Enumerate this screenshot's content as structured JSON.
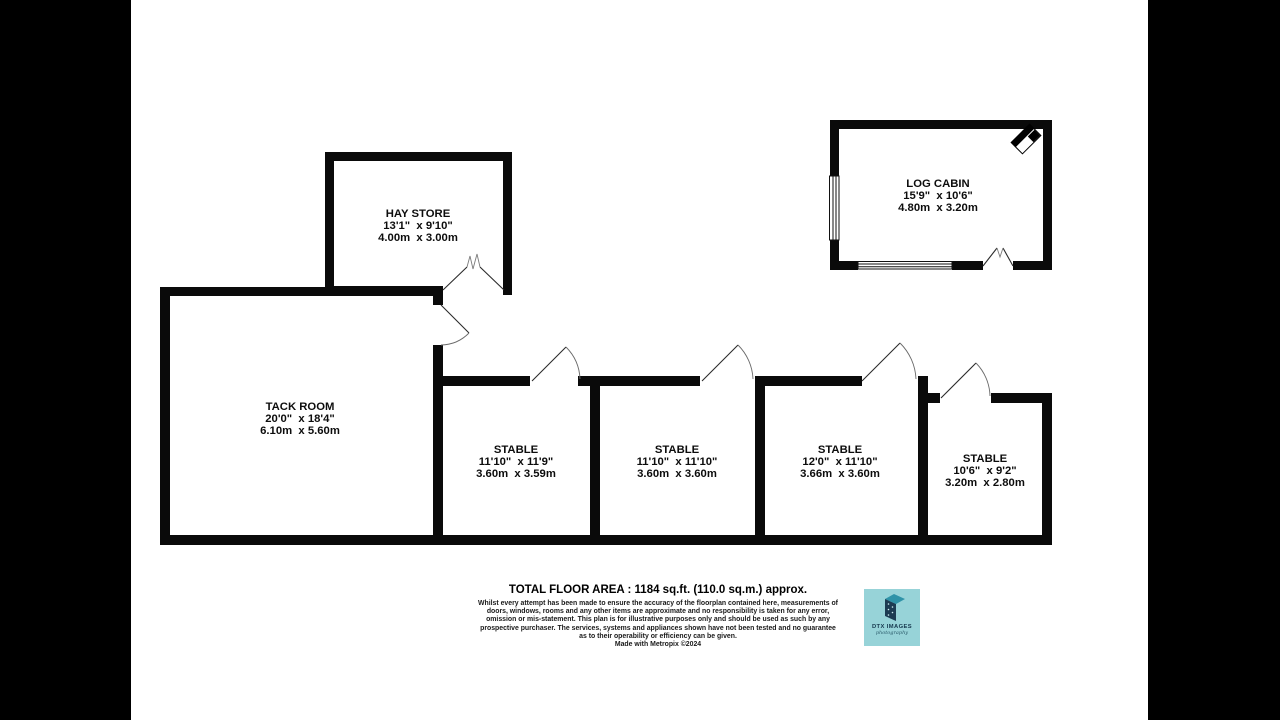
{
  "page": {
    "background": "#ffffff",
    "letterbox_color": "#000000",
    "wall_color": "#0a0a0a"
  },
  "rooms": [
    {
      "name": "HAY STORE",
      "imperial": "13'1\"  x 9'10\"",
      "metric": "4.00m  x 3.00m"
    },
    {
      "name": "LOG CABIN",
      "imperial": "15'9\"  x 10'6\"",
      "metric": "4.80m  x 3.20m"
    },
    {
      "name": "TACK ROOM",
      "imperial": "20'0\"  x 18'4\"",
      "metric": "6.10m  x 5.60m"
    },
    {
      "name": "STABLE",
      "imperial": "11'10\"  x 11'9\"",
      "metric": "3.60m  x 3.59m"
    },
    {
      "name": "STABLE",
      "imperial": "11'10\"  x 11'10\"",
      "metric": "3.60m  x 3.60m"
    },
    {
      "name": "STABLE",
      "imperial": "12'0\"  x 11'10\"",
      "metric": "3.66m  x 3.60m"
    },
    {
      "name": "STABLE",
      "imperial": "10'6\"  x 9'2\"",
      "metric": "3.20m  x 2.80m"
    }
  ],
  "footer": {
    "total_area": "TOTAL FLOOR AREA : 1184 sq.ft. (110.0 sq.m.) approx.",
    "disclaimer": "Whilst every attempt has been made to ensure the accuracy of the floorplan contained here, measurements of doors, windows, rooms and any other items are approximate and no responsibility is taken for any error, omission or mis-statement. This plan is for illustrative purposes only and should be used as such by any prospective purchaser. The services, systems and appliances shown have not been tested and no guarantee as to their operability or efficiency can be given.",
    "credit": "Made with Metropix ©2024"
  },
  "logo": {
    "title": "DTX IMAGES",
    "subtitle": "photography",
    "background": "#97d3d8",
    "shape_front_color": "#1c3b52",
    "shape_top_color": "#2f93a8",
    "text_color": "#16384e"
  }
}
